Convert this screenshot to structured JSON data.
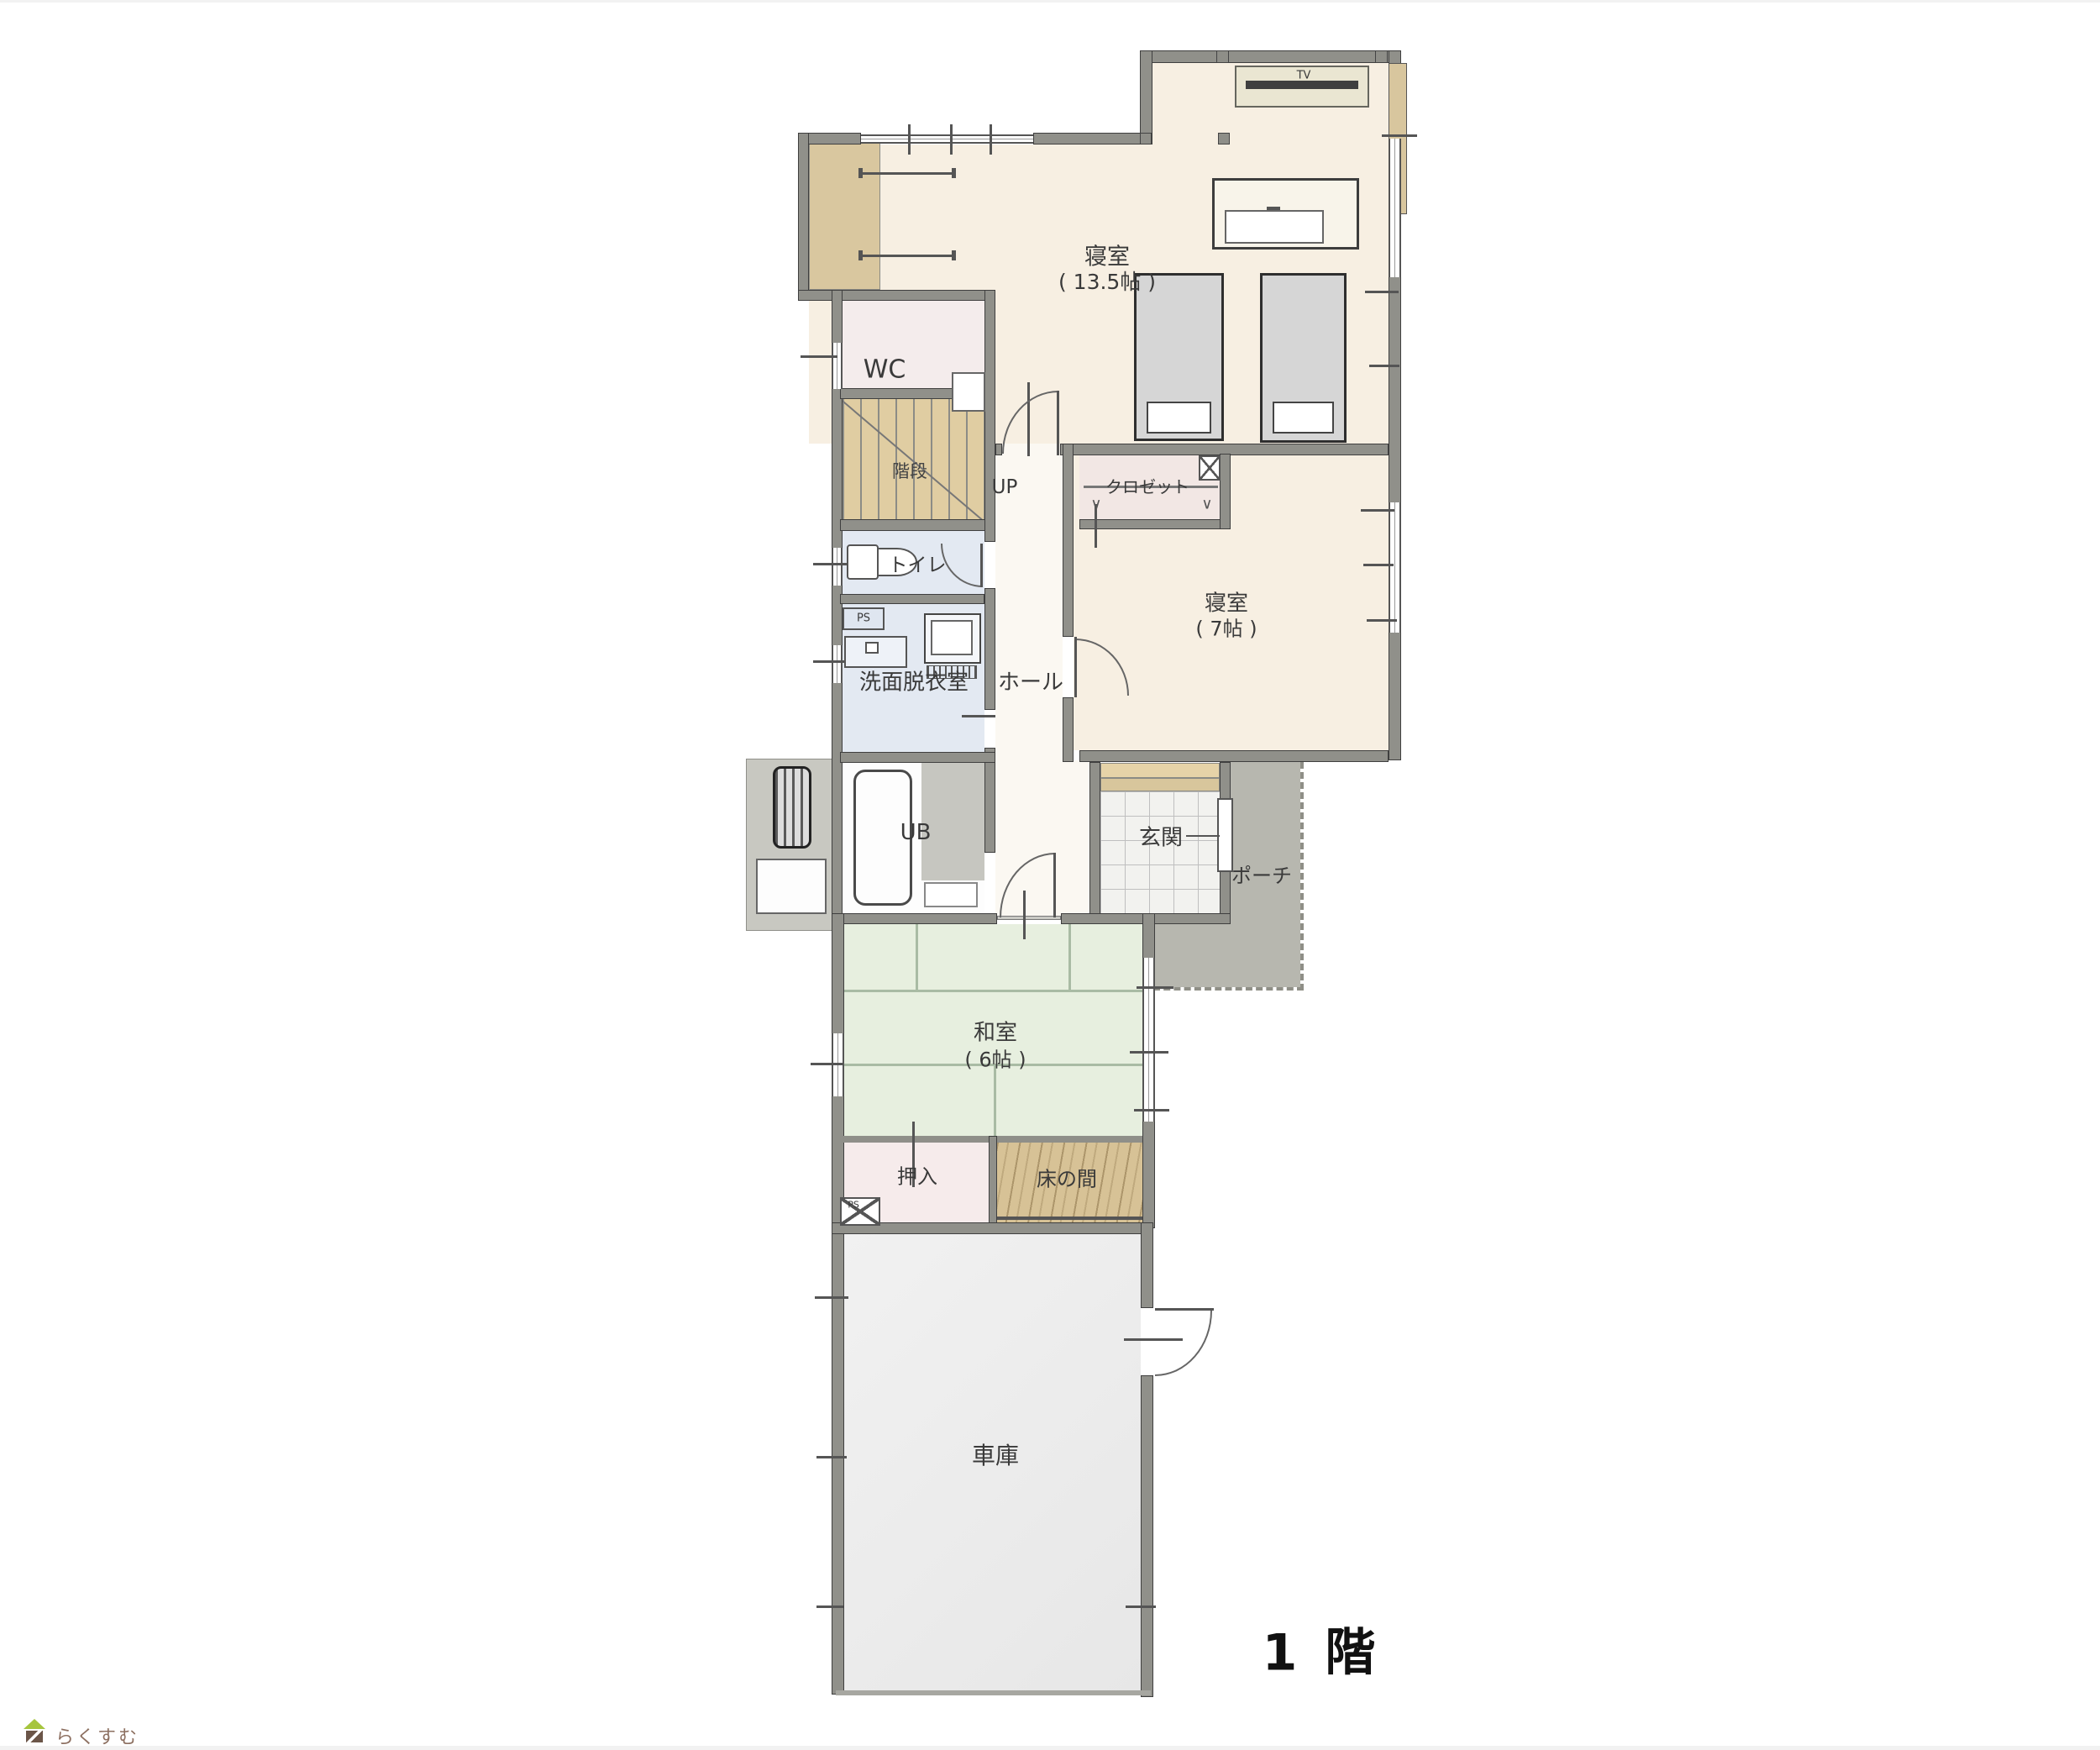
{
  "floor_label": "1 階",
  "watermark": {
    "brand": "らくすむ"
  },
  "furniture": {
    "tv_label": "TV"
  },
  "rooms": {
    "bedroom_main": {
      "name": "寝室",
      "size": "( 13.5帖 )"
    },
    "bedroom_second": {
      "name": "寝室",
      "size": "( 7帖 )"
    },
    "japanese_room": {
      "name": "和室",
      "size": "( 6帖 )"
    },
    "wc": {
      "name": "WC"
    },
    "stairs": {
      "name": "階段",
      "direction": "UP"
    },
    "toilet": {
      "name": "トイレ"
    },
    "washroom": {
      "name": "洗面脱衣室"
    },
    "hall": {
      "name": "ホール"
    },
    "closet": {
      "name": "クロゼット"
    },
    "bath": {
      "name": "UB"
    },
    "entrance": {
      "name": "玄関"
    },
    "porch": {
      "name": "ポーチ"
    },
    "oshiire": {
      "name": "押入"
    },
    "tokonoma": {
      "name": "床の間"
    },
    "garage": {
      "name": "車庫"
    },
    "pipe_space_upper": {
      "name": "PS"
    },
    "pipe_space_lower": {
      "name": "PS"
    }
  },
  "colors": {
    "floor_wood": "#f7efe2",
    "tatami": "#e7efdf",
    "wet_room": "#e3e9f2",
    "wall": "#90908a",
    "stairs": "#e0cda2",
    "porch": "#b7b7af",
    "garage": "#ededed",
    "closet_pink": "#f2e7e4",
    "tokonoma_wood": "#d7c296"
  }
}
